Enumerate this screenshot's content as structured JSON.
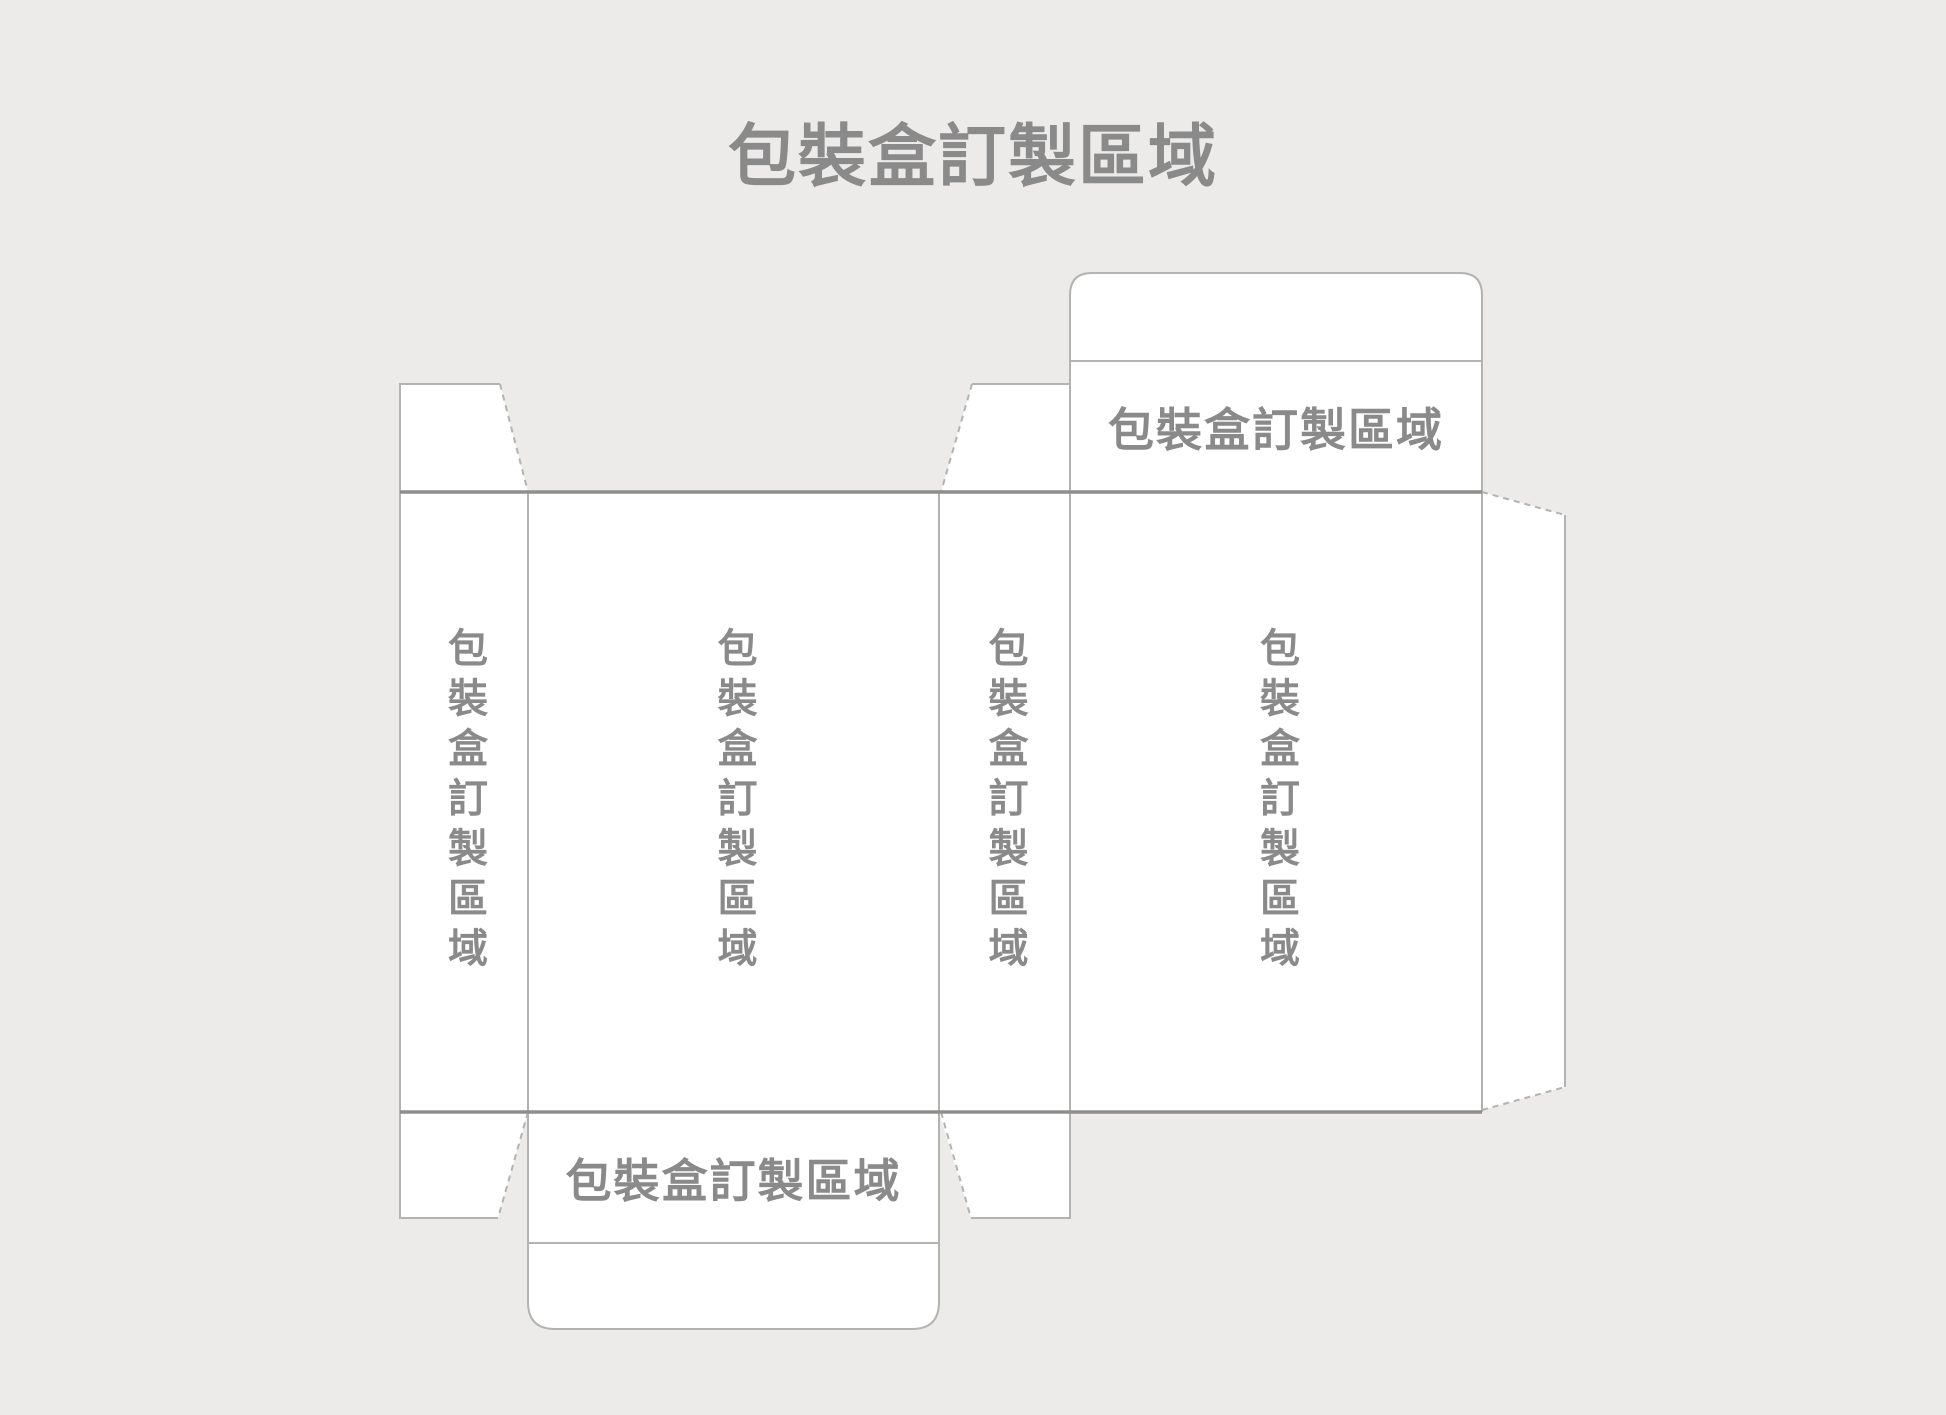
{
  "page": {
    "title": "包裝盒訂製區域",
    "background_color": "#ecebe9"
  },
  "colors": {
    "panel_fill": "#ffffff",
    "cut_line": "#b3b3b1",
    "fold_line": "#8e8e8c",
    "label_text": "#8a8a8a"
  },
  "dieline": {
    "description_labels": {
      "top_tuck_strip": "包裝盒訂製區域",
      "bottom_tuck_strip": "包裝盒訂製區域"
    },
    "panels": [
      {
        "id": "side-panel-left",
        "label": "包裝盒訂製區域",
        "orientation": "vertical"
      },
      {
        "id": "front-panel",
        "label": "包裝盒訂製區域",
        "orientation": "vertical"
      },
      {
        "id": "side-panel-right",
        "label": "包裝盒訂製區域",
        "orientation": "vertical"
      },
      {
        "id": "back-panel",
        "label": "包裝盒訂製區域",
        "orientation": "vertical"
      }
    ]
  }
}
